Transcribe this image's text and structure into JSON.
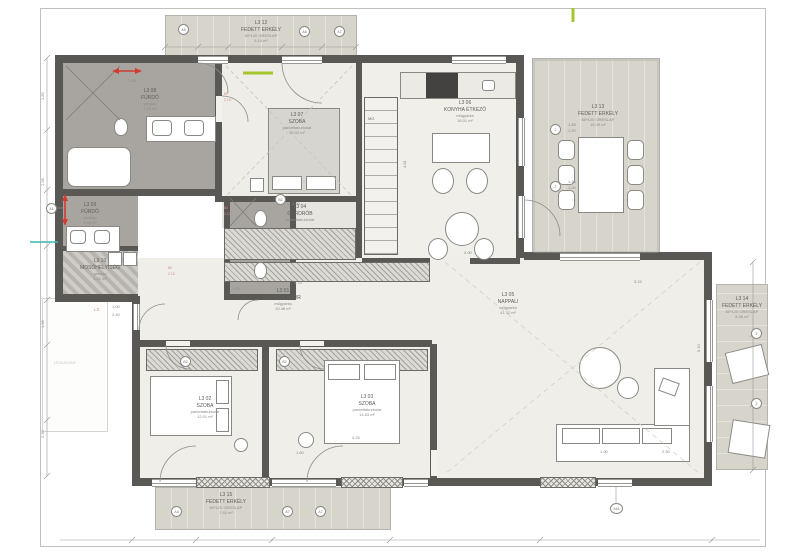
{
  "rooms": [
    {
      "id": "L3 08",
      "name": "FÜRDŐ",
      "finish": "greslap",
      "area": "7.19 m²"
    },
    {
      "id": "L3 07",
      "name": "SZOBA",
      "finish": "parkettaburkolat",
      "area": "19.02 m²"
    },
    {
      "id": "L3 04",
      "name": "GARDRÓB",
      "finish": "parkettaburkolat",
      "area": "5.24 m²"
    },
    {
      "id": "L3 06",
      "name": "KONYHA ÉTKEZŐ",
      "finish": "műgyanta",
      "area": "18.01 m²"
    },
    {
      "id": "L3 09",
      "name": "FÜRDŐ",
      "finish": "greslap",
      "area": "5.98 m²"
    },
    {
      "id": "L3 10",
      "name": "MOSÓHELYISÉG",
      "finish": "greslap",
      "area": "1.21 m²"
    },
    {
      "id": "L3 01",
      "name": "ELŐSZ/GARDR",
      "finish": "műgyanta",
      "area": "10.48 m²"
    },
    {
      "id": "L3 02",
      "name": "SZOBA",
      "finish": "parkettaburkolat",
      "area": "12.01 m²"
    },
    {
      "id": "L3 03",
      "name": "SZOBA",
      "finish": "parkettaburkolat",
      "area": "14.83 m²"
    },
    {
      "id": "L3 05",
      "name": "NAPPALI",
      "finish": "műgyanta",
      "area": "41.32 m²"
    }
  ],
  "balconies": [
    {
      "id": "L3 12",
      "name": "FEDETT ERKÉLY",
      "finish": "60*120 GRESLAP",
      "area": "5.10 m²"
    },
    {
      "id": "L3 13",
      "name": "FEDETT ERKÉLY",
      "finish": "60*120 GRESLAP",
      "area": "16.49 m²"
    },
    {
      "id": "L3 14",
      "name": "FEDETT ERKÉLY",
      "finish": "60*120 GRESLAP",
      "area": "8.36 m²"
    },
    {
      "id": "L3 15",
      "name": "FEDETT ERKÉLY",
      "finish": "60*120 GRESLAP",
      "area": "7.40 m²"
    }
  ],
  "annotations": {
    "mg": "MG",
    "legudvar": "LÉGUDVAR",
    "l3_pink": "L3",
    "door_w": "80",
    "door_h": "2.10",
    "door2_w": "1.00",
    "door2_h": "2.40"
  },
  "markers": [
    "A1",
    "A5",
    "A6",
    "A7",
    "2",
    "2",
    "2",
    "2",
    "A4",
    "A7",
    "A7",
    "A14",
    "B2",
    "B2",
    "B2"
  ],
  "dims": [
    "1.50",
    "1.90",
    "1.80",
    "2.58",
    "1.68",
    "2.30",
    "1.20",
    "3.90",
    "4.25",
    "1.00",
    "2.40",
    "1.60",
    "4.81",
    "1.45",
    "1.20",
    "1.90",
    "2.30",
    "5.10",
    "4.75",
    "3.15"
  ],
  "colors": {
    "wall": "#5a5855",
    "bath_floor": "#a8a5a0",
    "room_floor": "#efeee9",
    "balcony": "#d7d4cc",
    "accent_red": "#d23b2f",
    "accent_green": "#a4c62b",
    "accent_cyan": "#3bb8b1",
    "accent_pink": "#d98a85"
  }
}
